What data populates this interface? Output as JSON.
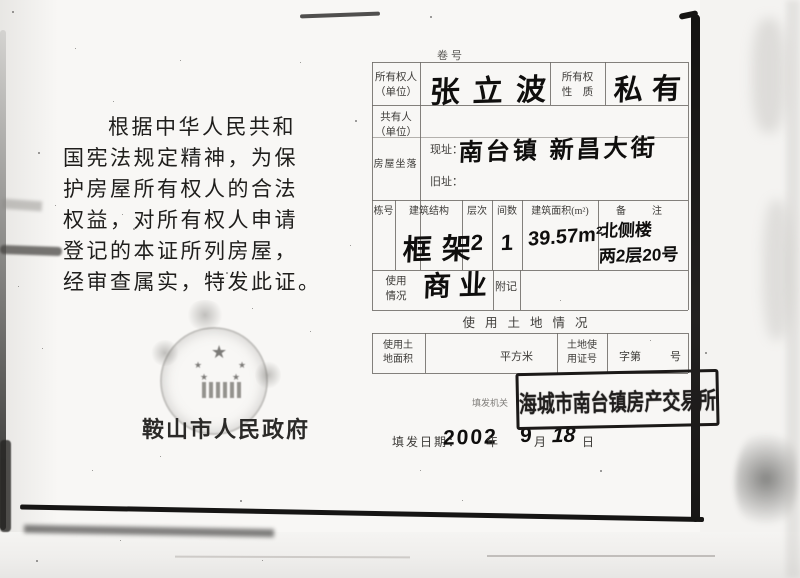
{
  "document": {
    "volume_label": "卷号",
    "left_page": {
      "paragraph": [
        "根据中华人民共和",
        "国宪法规定精神，为保",
        "护房屋所有权人的合法",
        "权益，对所有权人申请",
        "登记的本证所列房屋，",
        "经审查属实，特发此证。"
      ],
      "issuer": "鞍山市人民政府"
    },
    "form": {
      "owner": {
        "label1": "所有权人",
        "label2": "（单位）",
        "value": "张立波"
      },
      "ownership": {
        "label1": "所有权",
        "label2": "性　质",
        "value": "私有"
      },
      "co_owner": {
        "label1": "共有人",
        "label2": "（单位）"
      },
      "location": {
        "label": "房屋坐落",
        "current_label": "现址：",
        "current_value": "南台镇 新昌大街",
        "old_label": "旧址："
      },
      "building": {
        "headers": [
          "栋号",
          "建筑结构",
          "层次",
          "间数",
          "建筑面积(m²)",
          "备　注"
        ],
        "row": {
          "structure": "框架",
          "floors": "2",
          "rooms": "1",
          "area": "39.57m²",
          "remark1": "北侧楼",
          "remark2": "两2层20号"
        }
      },
      "usage": {
        "label1": "使用",
        "label2": "情况",
        "value": "商业"
      },
      "annex_label": "附记",
      "land_section": {
        "title": "使用土地情况",
        "area_label1": "使用土",
        "area_label2": "地面积",
        "unit": "平方米",
        "cert_label1": "土地使",
        "cert_label2": "用证号",
        "cert_prefix": "字第",
        "cert_suffix": "号"
      },
      "issuing": {
        "org_label": "填发机关",
        "stamp": "海城市南台镇房产交易所",
        "date_label": "填发日期：",
        "year": "2002",
        "year_unit": "年",
        "month": "9",
        "month_unit": "月",
        "day": "18",
        "day_unit": "日"
      }
    }
  }
}
